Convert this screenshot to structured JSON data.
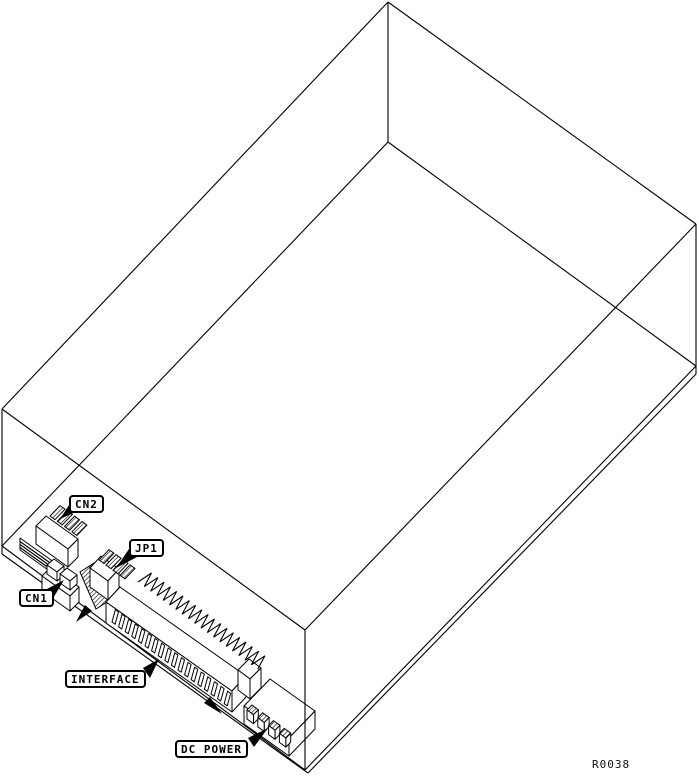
{
  "figure": {
    "callouts": [
      {
        "id": "cn2",
        "label": "CN2"
      },
      {
        "id": "cn1",
        "label": "CN1"
      },
      {
        "id": "jp1",
        "label": "JP1"
      },
      {
        "id": "interface",
        "label": "INTERFACE"
      },
      {
        "id": "dc-power",
        "label": "DC POWER"
      }
    ],
    "reference": "R0038",
    "colors": {
      "line": "#000000",
      "background": "#ffffff"
    }
  }
}
